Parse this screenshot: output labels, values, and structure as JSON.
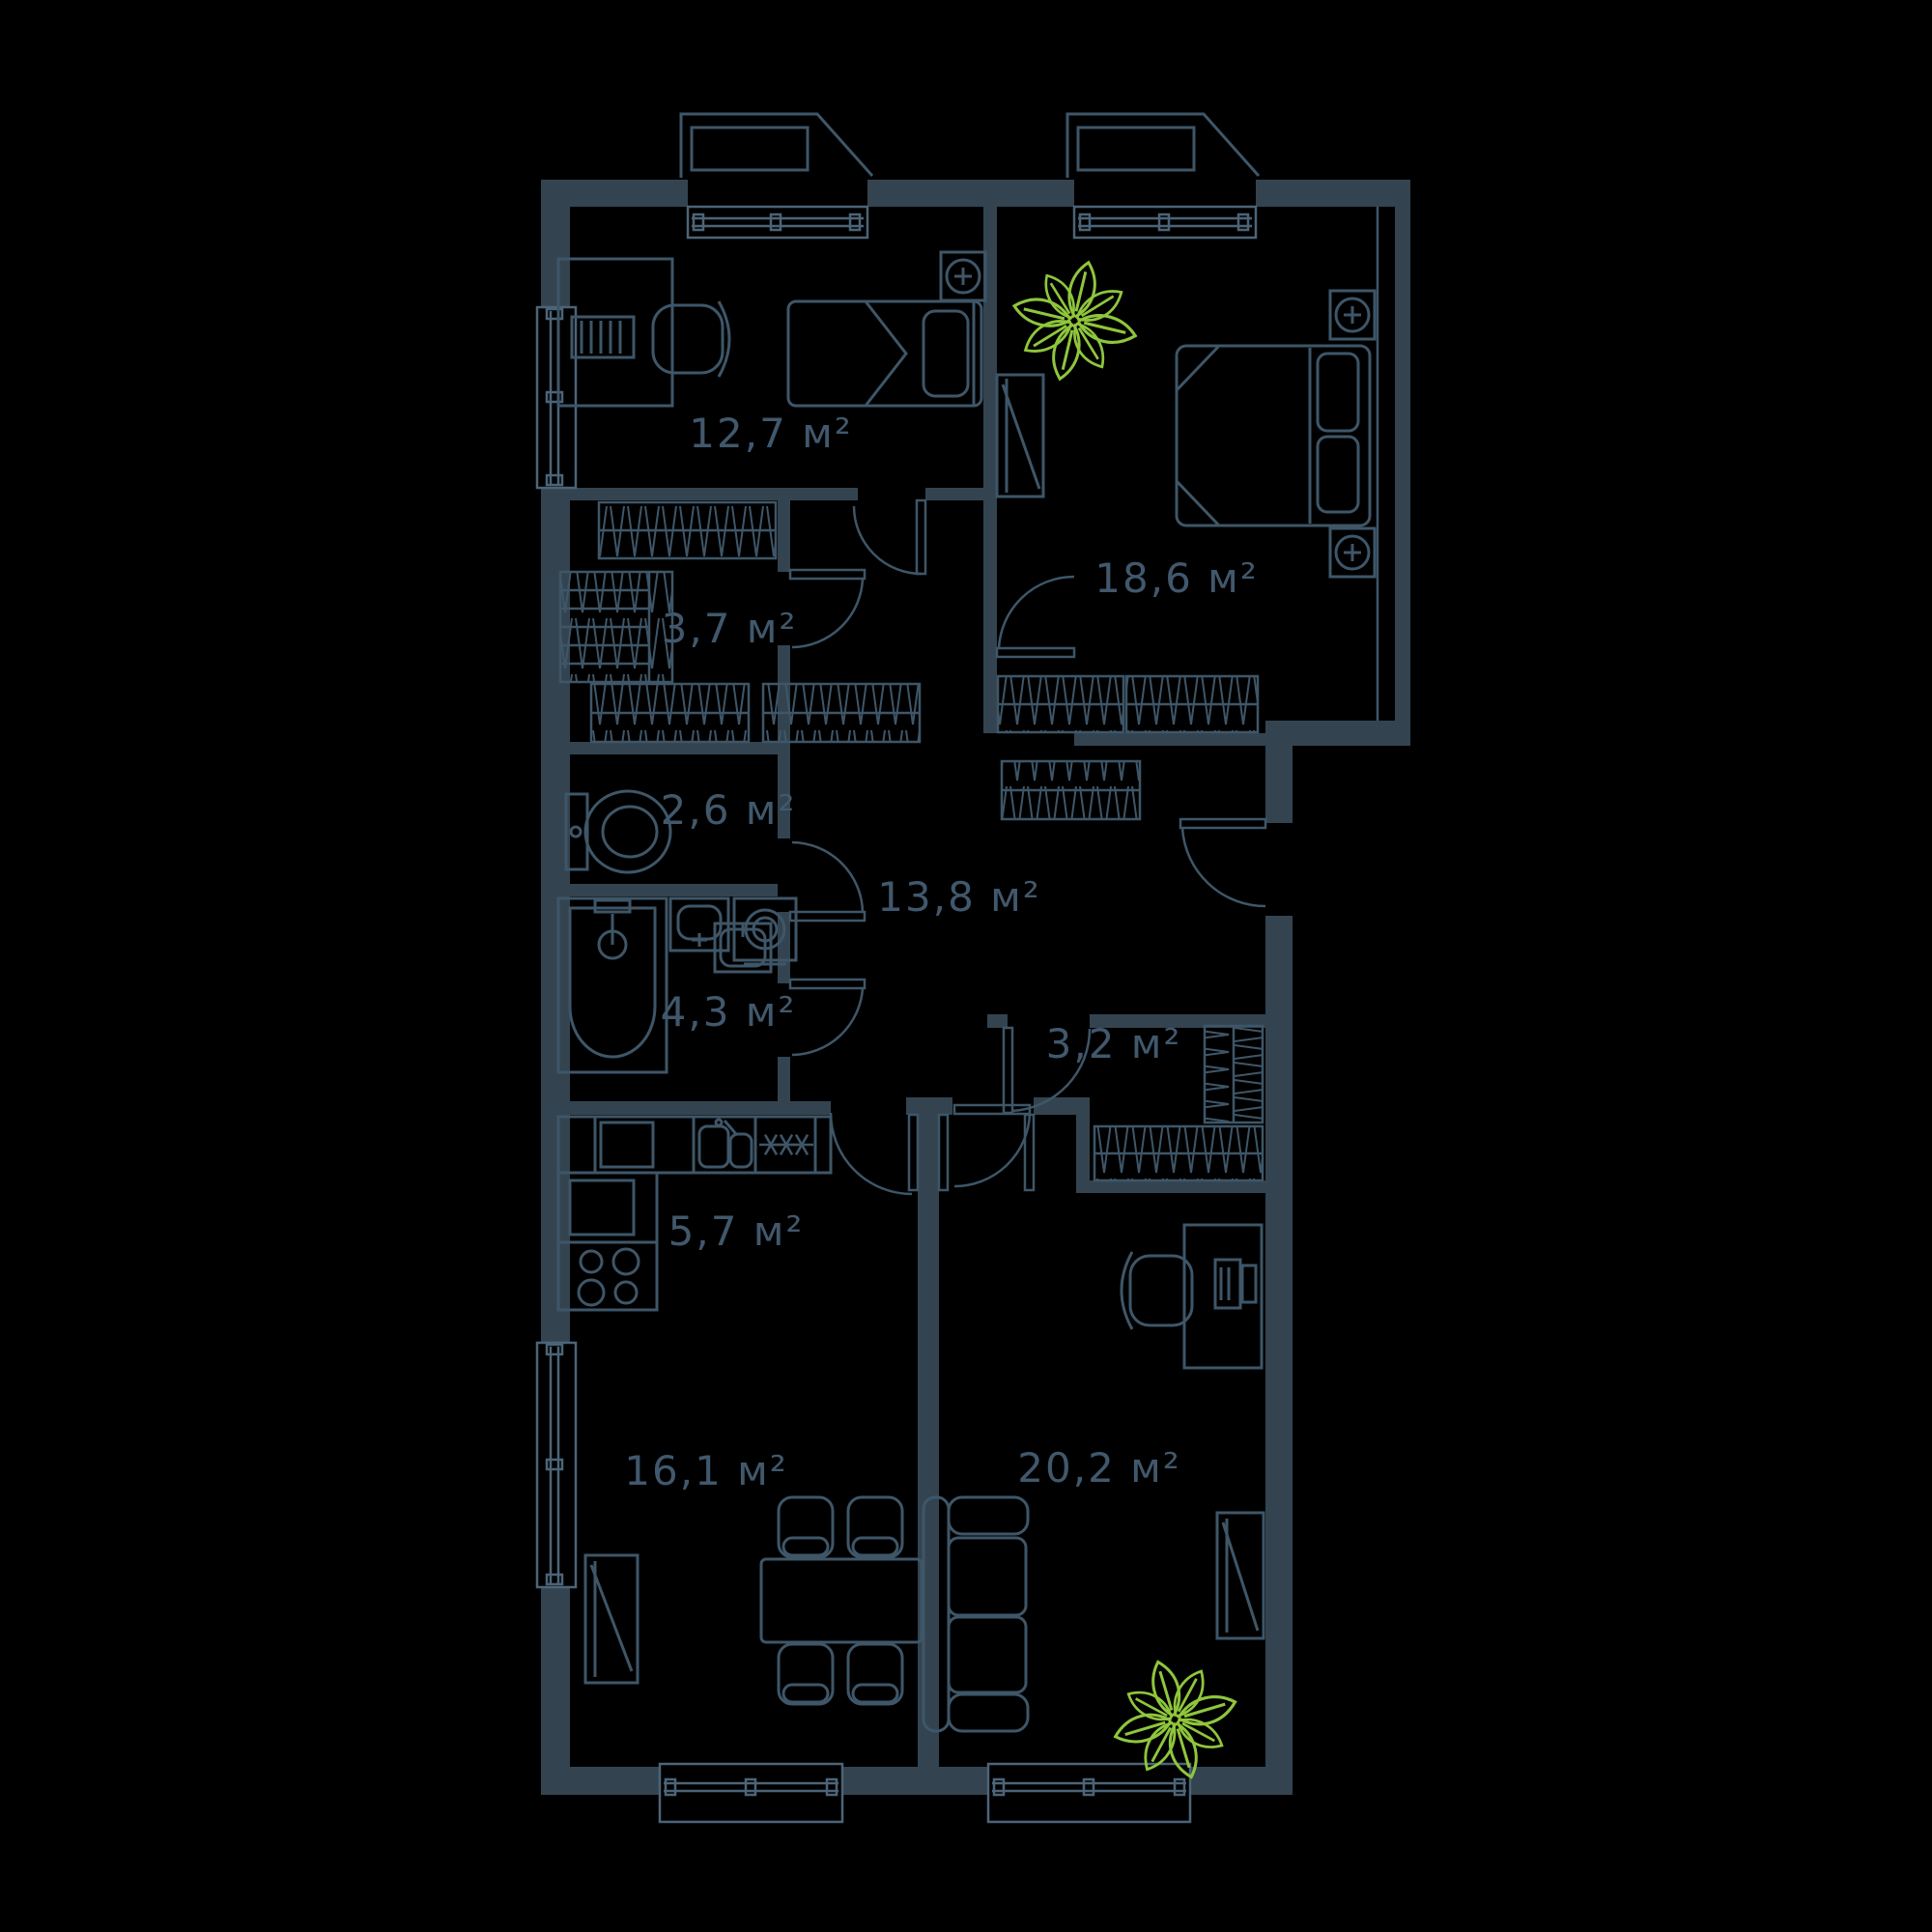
{
  "document": {
    "kind": "apartment-floor-plan",
    "background": "#000000"
  },
  "colors": {
    "wall_fill": "#334450",
    "line": "#3e5668",
    "window_line": "#4c6478",
    "label_text": "#41586c",
    "plant_green": "#8fc63c"
  },
  "rooms": [
    {
      "id": "bedroom-1",
      "area": "12,7 м²"
    },
    {
      "id": "bedroom-2",
      "area": "18,6 м²"
    },
    {
      "id": "closet",
      "area": "3,7 м²"
    },
    {
      "id": "wc",
      "area": "2,6 м²"
    },
    {
      "id": "hallway",
      "area": "13,8 м²"
    },
    {
      "id": "bathroom",
      "area": "4,3 м²"
    },
    {
      "id": "storage",
      "area": "3,2 м²"
    },
    {
      "id": "kitchen",
      "area": "5,7 м²"
    },
    {
      "id": "living-room",
      "area": "16,1 м²"
    },
    {
      "id": "bedroom-3",
      "area": "20,2 м²"
    }
  ],
  "icons": {
    "plant": "plant-icon",
    "lamp": "wall-lamp-icon",
    "burners": "stove-burner-icon"
  }
}
